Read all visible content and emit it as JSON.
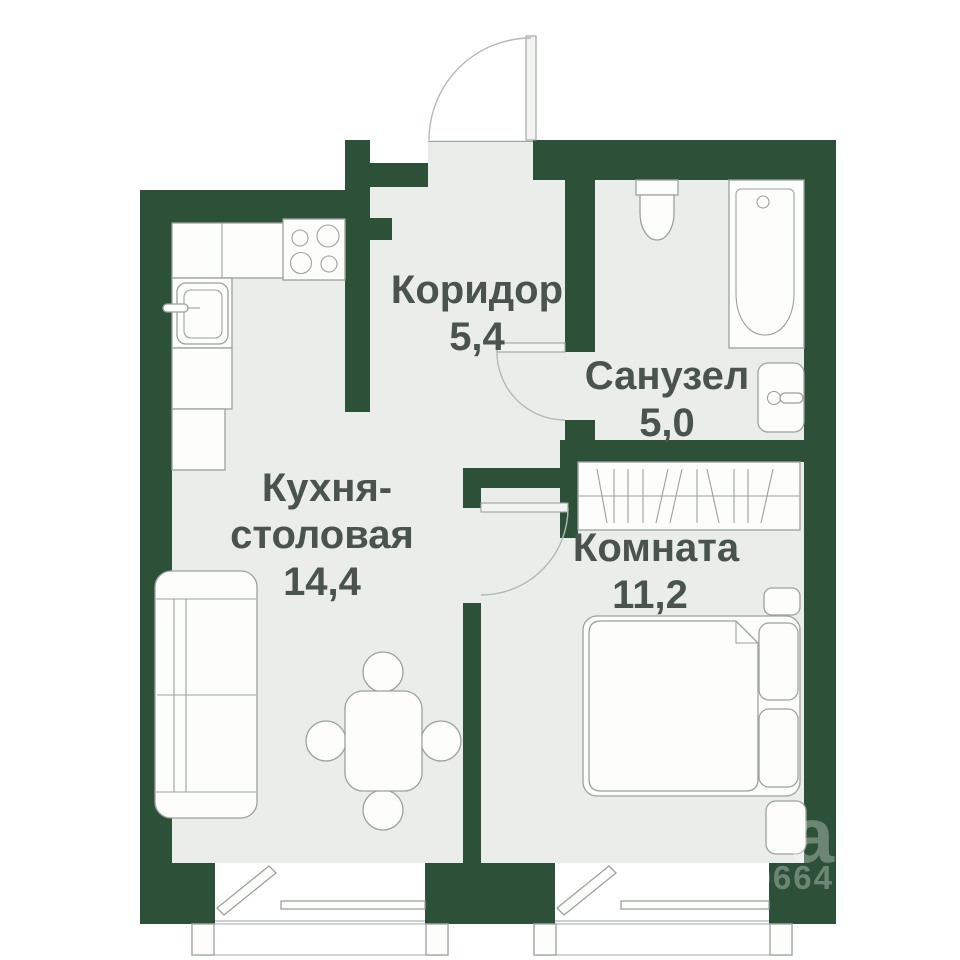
{
  "colors": {
    "wall": "#2d5038",
    "floor": "#ebedeb",
    "line": "#9aa39d",
    "line_soft": "#b3b9b4",
    "furniture": "#fdfdfc",
    "text": "#49544f",
    "bg": "#ffffff"
  },
  "rooms": [
    {
      "id": "corridor",
      "label": "Коридор",
      "area": "5,4"
    },
    {
      "id": "bathroom",
      "label": "Санузел",
      "area": "5,0"
    },
    {
      "id": "kitchen",
      "label_line1": "Кухня-",
      "label_line2": "столовая",
      "area": "14,4"
    },
    {
      "id": "room",
      "label": "Комната",
      "area": "11,2"
    }
  ],
  "watermark": {
    "letter": "а",
    "number": "9664"
  }
}
